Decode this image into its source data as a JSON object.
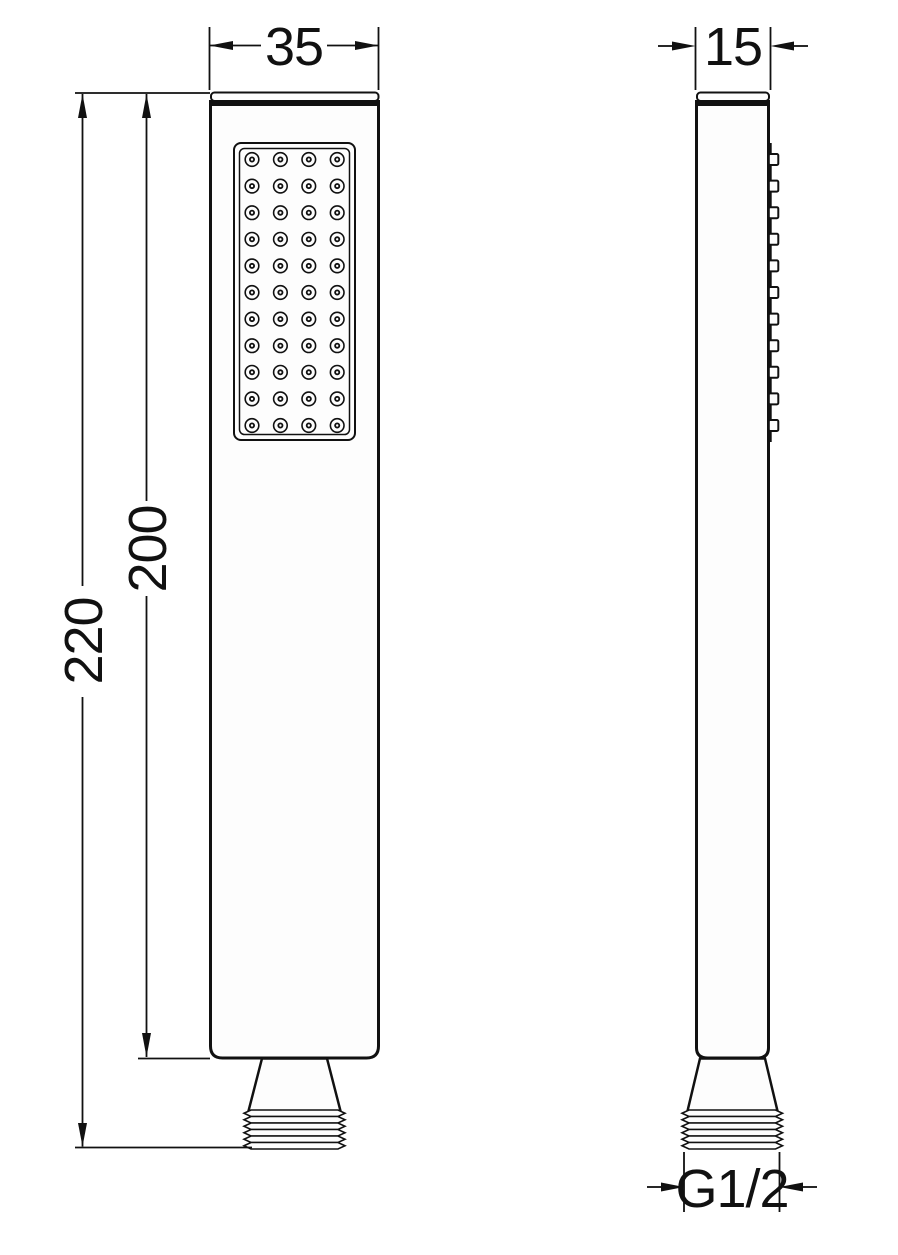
{
  "drawing": {
    "kind": "technical-dimension-drawing",
    "subject": "square-hand-shower",
    "views": {
      "front": {
        "name": "front-view"
      },
      "side": {
        "name": "side-view"
      }
    }
  },
  "dimensions": {
    "head_width": "35",
    "total_length": "220",
    "body_length": "200",
    "head_depth": "15",
    "thread_size": "G1/2"
  },
  "spray_grid": {
    "columns": 4,
    "rows": 11
  },
  "colors": {
    "line": "#111111",
    "fill": "#fdfdfd",
    "background": "#ffffff"
  }
}
